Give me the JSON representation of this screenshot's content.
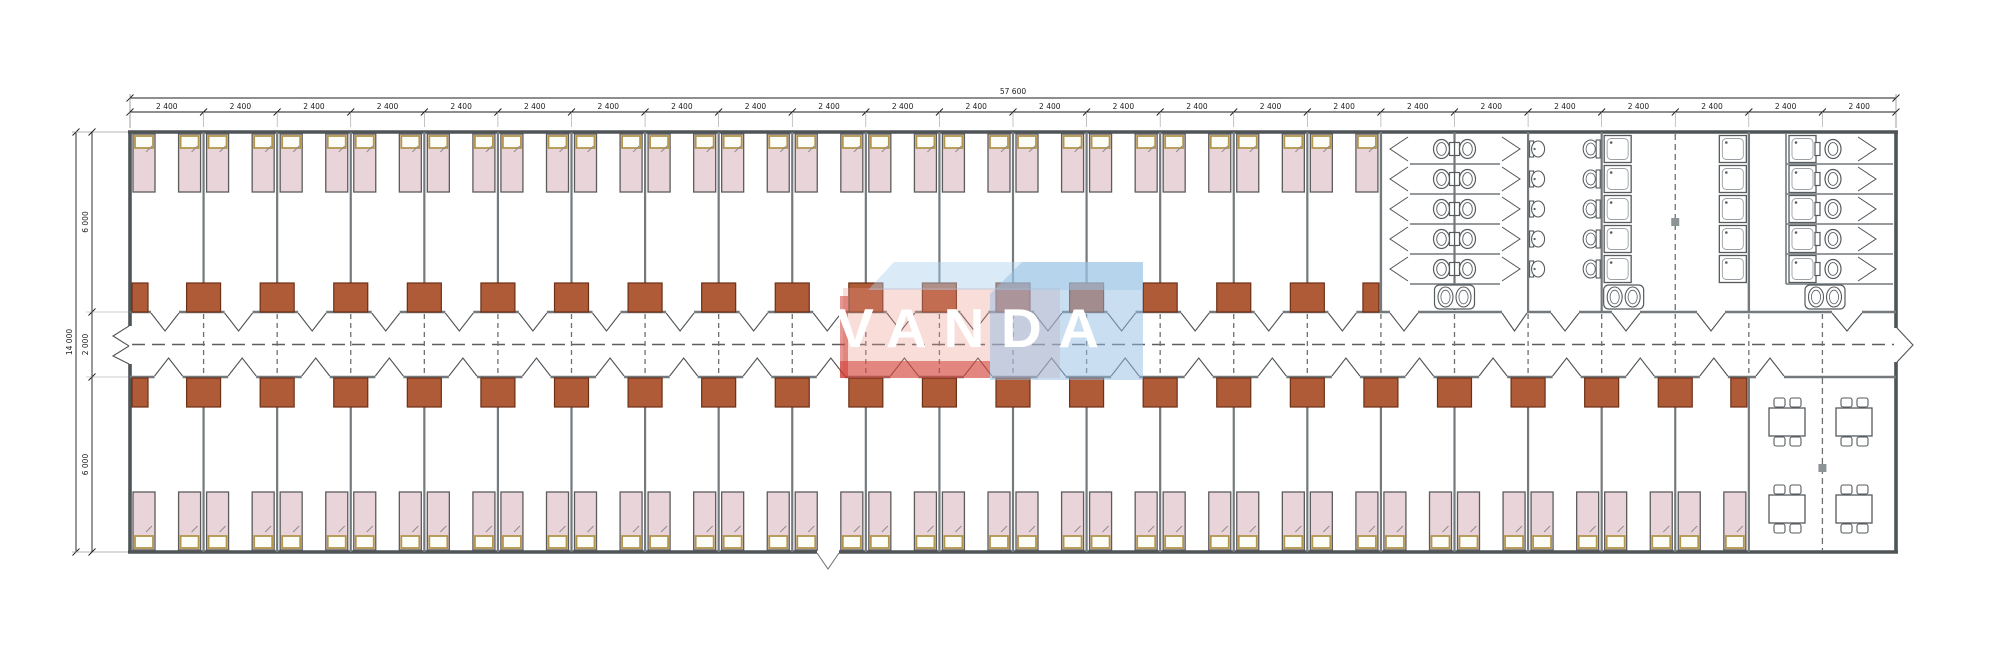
{
  "watermark": {
    "text": "VANDA"
  },
  "dimensions": {
    "top_total_label": "57 600",
    "bay_width_label": "2 400",
    "bay_count": 24,
    "left_total_label": "14 000",
    "left_segment_labels": [
      "6 000",
      "2 000",
      "6 000"
    ]
  },
  "rooms": {
    "top_bedroom_count": 17,
    "bottom_bedroom_count": 22,
    "beds_per_room": 2,
    "wardrobe_blocks_top": 18,
    "wardrobe_blocks_bottom": 23,
    "sanitary": {
      "wc_cubicle_rows": 5,
      "back_to_back_wc_cubicles": 10,
      "small_washbasins": 5,
      "large_washbasins": 5,
      "shower_trays_left_room": 5,
      "shower_trays_right_room": 5,
      "shower_wc_cubicles": 5,
      "double_sinks": 3
    },
    "dining": {
      "tables": 4,
      "chairs_per_table": 4
    }
  },
  "colors": {
    "bed_fill": "#e9d4d9",
    "bed_stroke": "#5c5c5c",
    "pillow_fill": "#fdfdf8",
    "pillow_border": "#b3964e",
    "wardrobe_fill": "#b05b38",
    "wardrobe_stroke": "#6d3014",
    "wall": "#73797c",
    "outer_wall": "#4f5456",
    "fixture_stroke": "#565b5e",
    "dash": "#6b7073",
    "dimension": "#1c1c1c",
    "joint_marker": "#8d9497",
    "watermark_red": "rgba(205,48,40,0.50)",
    "watermark_pink": "rgba(232,148,138,0.32)",
    "watermark_blue": "rgba(148,190,228,0.50)",
    "watermark_light_blue": "rgba(172,208,238,0.45)"
  }
}
